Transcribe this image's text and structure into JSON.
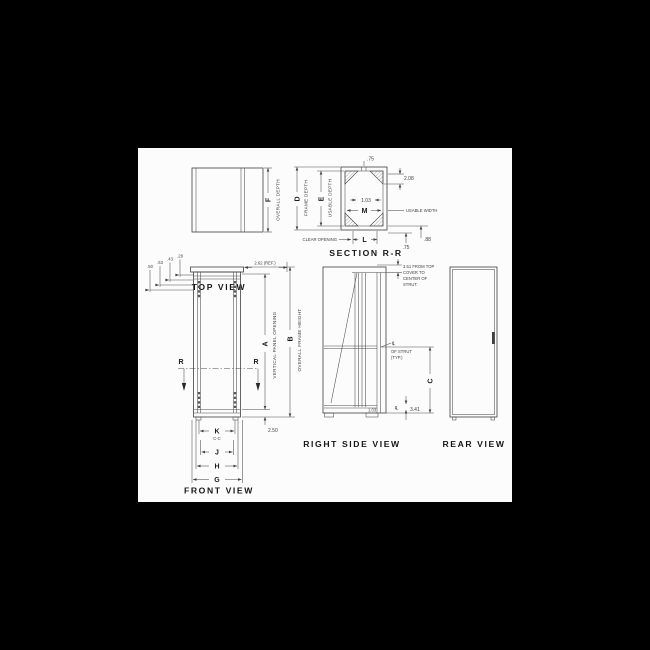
{
  "window": {
    "background": "#000000",
    "paper": "#fcfcfc",
    "ink": "#3f3f3f"
  },
  "views": {
    "top": {
      "title": "TOP VIEW",
      "dim_f": "F",
      "overall_depth": "OVERALL DEPTH"
    },
    "section": {
      "title": "SECTION R-R",
      "dim_d": "D",
      "frame_depth": "FRAME DEPTH",
      "dim_e": "E",
      "usable_depth": "USABLE DEPTH",
      "dim_m": "M",
      "dim_l": "L",
      "usable_width": "USABLE WIDTH",
      "clear_opening": "CLEAR OPENING",
      "top_strut_width": ".75",
      "right_offset": "2.08",
      "strut_spacing": "1.03",
      "bottom_flange": ".75",
      "bottom_offset": ".88"
    },
    "front": {
      "title": "FRONT VIEW",
      "offsets": [
        ".50",
        ".63",
        ".43",
        ".28"
      ],
      "top_ref": "2.62 (REF.)",
      "dim_a": "A",
      "vertical_panel_opening": "VERTICAL PANEL OPENING",
      "dim_b": "B",
      "overall_frame_height": "OVERALL FRAME HEIGHT",
      "section_marker": "R",
      "base_height": "2.50",
      "dim_k": "K",
      "k_note": "C-C",
      "dim_j": "J",
      "dim_h": "H",
      "dim_g": "G"
    },
    "side": {
      "title": "RIGHT SIDE VIEW",
      "note_line1": "3.51 FROM TOP",
      "note_line2": "COVER TO",
      "note_line3": "CENTER OF",
      "note_line4": "STRUT.",
      "centerline": "℄",
      "strut_note1": "OF STRUT",
      "strut_note2": "(TYP.)",
      "dim_c": "C",
      "strut_center": "3.41",
      "bottom_note": "1.03"
    },
    "rear": {
      "title": "REAR VIEW"
    }
  }
}
